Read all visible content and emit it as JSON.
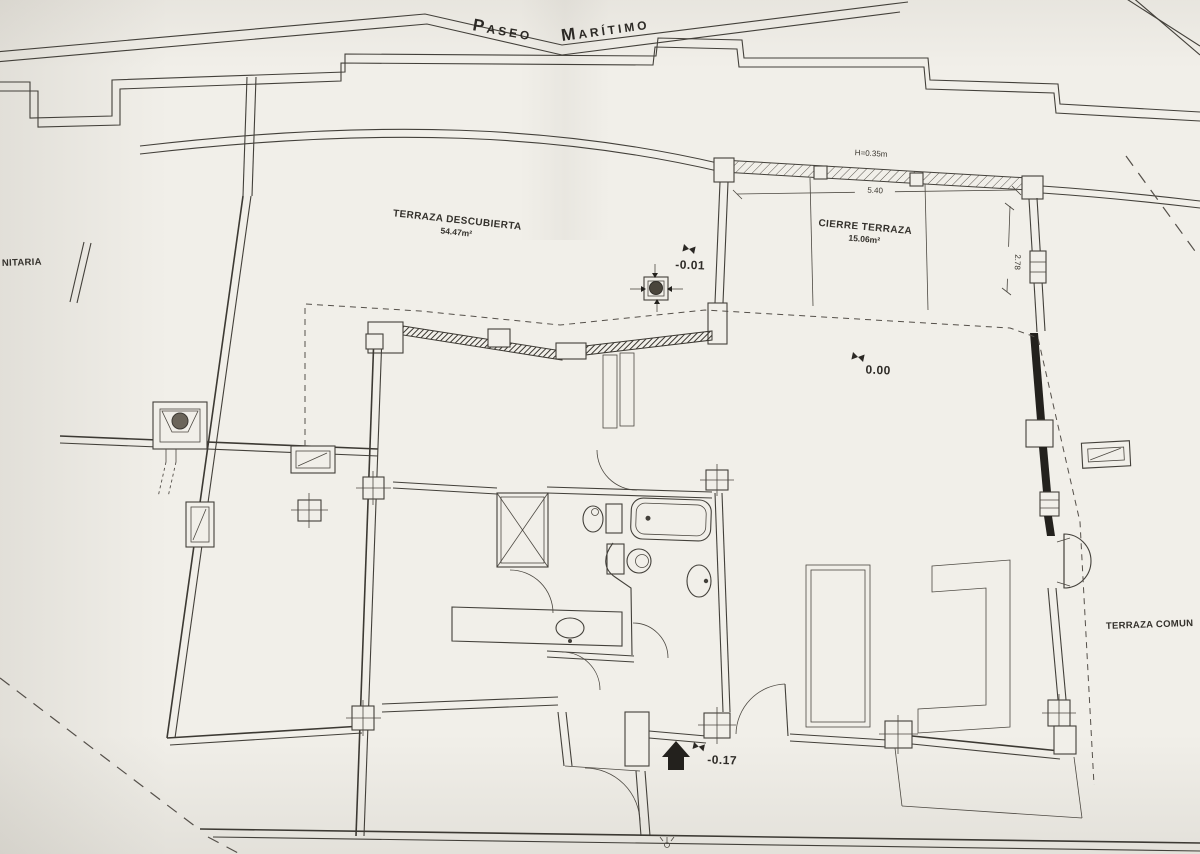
{
  "drawing": {
    "street": {
      "words": [
        "Paseo",
        "Marítimo"
      ]
    },
    "rooms": {
      "terraza_descubierta": {
        "label": "TERRAZA DESCUBIERTA",
        "area": "54.47m²"
      },
      "cierre_terraza": {
        "label": "CIERRE TERRAZA",
        "area": "15.06m²"
      }
    },
    "adjacent": {
      "left_fragment": "NITARIA",
      "right_fragment": "TERRAZA COMUN"
    },
    "levels": {
      "terrace_drain": "-0.01",
      "interior": "0.00",
      "entrance": "-0.17"
    },
    "dimensions": {
      "parapet_height": "H=0.35m",
      "terrace_width": "5.40",
      "terrace_depth": "2.78"
    },
    "colors": {
      "paper": "#f1efe9",
      "ink": "#43403a",
      "poche": "#23211d"
    }
  }
}
